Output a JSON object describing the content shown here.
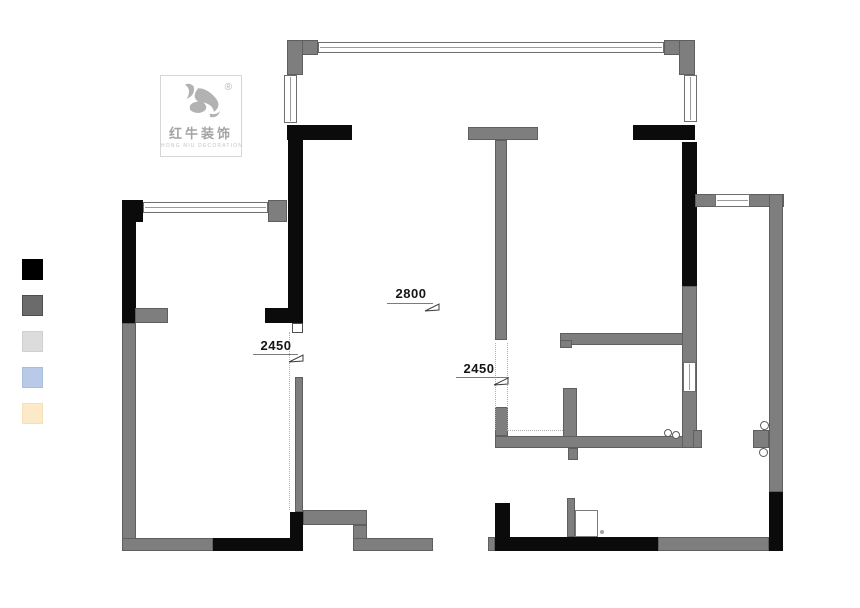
{
  "canvas": {
    "width": 860,
    "height": 608,
    "background": "#ffffff"
  },
  "logo": {
    "brand_cn": "红牛装饰",
    "brand_en": "HONG NIU DECORATION",
    "registered_mark": "®",
    "icon": "bull-logo-icon",
    "icon_color": "#b2b2b2"
  },
  "legend": {
    "swatches": [
      {
        "name": "black",
        "color": "#000000",
        "border": "#000000"
      },
      {
        "name": "dark-gray",
        "color": "#6b6b6b",
        "border": "#4e4e4e"
      },
      {
        "name": "light-gray",
        "color": "#dcdcdc",
        "border": "#d0d0d0"
      },
      {
        "name": "light-blue",
        "color": "#b8cae8",
        "border": "#a9bddf"
      },
      {
        "name": "cream",
        "color": "#fce9c8",
        "border": "#f6e0b8"
      }
    ]
  },
  "dimensions": [
    {
      "label": "2800",
      "text": {
        "x": 388,
        "y": 286,
        "w": 46
      },
      "line": {
        "x": 387,
        "y": 303,
        "w": 46
      },
      "flag": {
        "x": 424,
        "y": 303
      }
    },
    {
      "label": "2450",
      "text": {
        "x": 254,
        "y": 338,
        "w": 44
      },
      "line": {
        "x": 253,
        "y": 354,
        "w": 45
      },
      "flag": {
        "x": 288,
        "y": 354
      }
    },
    {
      "label": "2450",
      "text": {
        "x": 457,
        "y": 361,
        "w": 44
      },
      "line": {
        "x": 456,
        "y": 377,
        "w": 53
      },
      "flag": {
        "x": 493,
        "y": 377
      }
    }
  ],
  "floorplan": {
    "wall_color_black": "#0b0b0b",
    "wall_color_gray": "#7e7e7e",
    "black_walls": [
      {
        "x": 287,
        "y": 125,
        "w": 65,
        "h": 15
      },
      {
        "x": 633,
        "y": 125,
        "w": 62,
        "h": 15
      },
      {
        "x": 288,
        "y": 140,
        "w": 15,
        "h": 183
      },
      {
        "x": 265,
        "y": 308,
        "w": 38,
        "h": 15
      },
      {
        "x": 122,
        "y": 200,
        "w": 21,
        "h": 22
      },
      {
        "x": 122,
        "y": 222,
        "w": 14,
        "h": 101
      },
      {
        "x": 682,
        "y": 142,
        "w": 15,
        "h": 144
      },
      {
        "x": 213,
        "y": 538,
        "w": 90,
        "h": 13
      },
      {
        "x": 290,
        "y": 512,
        "w": 13,
        "h": 26
      },
      {
        "x": 495,
        "y": 503,
        "w": 15,
        "h": 34
      },
      {
        "x": 495,
        "y": 537,
        "w": 163,
        "h": 14
      },
      {
        "x": 769,
        "y": 492,
        "w": 14,
        "h": 59
      }
    ],
    "gray_walls": [
      {
        "x": 287,
        "y": 40,
        "w": 31,
        "h": 15
      },
      {
        "x": 287,
        "y": 40,
        "w": 16,
        "h": 35
      },
      {
        "x": 664,
        "y": 40,
        "w": 31,
        "h": 15
      },
      {
        "x": 679,
        "y": 40,
        "w": 16,
        "h": 35
      },
      {
        "x": 468,
        "y": 127,
        "w": 70,
        "h": 13
      },
      {
        "x": 495,
        "y": 140,
        "w": 12,
        "h": 200
      },
      {
        "x": 268,
        "y": 200,
        "w": 19,
        "h": 22
      },
      {
        "x": 135,
        "y": 308,
        "w": 33,
        "h": 15
      },
      {
        "x": 122,
        "y": 323,
        "w": 14,
        "h": 228
      },
      {
        "x": 122,
        "y": 538,
        "w": 91,
        "h": 13
      },
      {
        "x": 303,
        "y": 510,
        "w": 64,
        "h": 15
      },
      {
        "x": 353,
        "y": 525,
        "w": 14,
        "h": 26
      },
      {
        "x": 353,
        "y": 538,
        "w": 80,
        "h": 13
      },
      {
        "x": 295,
        "y": 377,
        "w": 8,
        "h": 135
      },
      {
        "x": 560,
        "y": 333,
        "w": 123,
        "h": 12
      },
      {
        "x": 560,
        "y": 340,
        "w": 12,
        "h": 8
      },
      {
        "x": 563,
        "y": 388,
        "w": 14,
        "h": 60
      },
      {
        "x": 568,
        "y": 448,
        "w": 10,
        "h": 12
      },
      {
        "x": 495,
        "y": 436,
        "w": 202,
        "h": 12
      },
      {
        "x": 495,
        "y": 407,
        "w": 13,
        "h": 29
      },
      {
        "x": 682,
        "y": 286,
        "w": 15,
        "h": 162
      },
      {
        "x": 693,
        "y": 430,
        "w": 9,
        "h": 18
      },
      {
        "x": 695,
        "y": 194,
        "w": 89,
        "h": 13
      },
      {
        "x": 769,
        "y": 194,
        "w": 14,
        "h": 298
      },
      {
        "x": 753,
        "y": 430,
        "w": 16,
        "h": 18
      },
      {
        "x": 658,
        "y": 537,
        "w": 111,
        "h": 14
      },
      {
        "x": 488,
        "y": 537,
        "w": 7,
        "h": 14
      },
      {
        "x": 567,
        "y": 498,
        "w": 8,
        "h": 39
      }
    ],
    "windows": [
      {
        "x": 318,
        "y": 42,
        "w": 346,
        "h": 11,
        "o": "h"
      },
      {
        "x": 284,
        "y": 75,
        "w": 13,
        "h": 48,
        "o": "v"
      },
      {
        "x": 684,
        "y": 75,
        "w": 13,
        "h": 47,
        "o": "v"
      },
      {
        "x": 143,
        "y": 202,
        "w": 125,
        "h": 11,
        "o": "h"
      },
      {
        "x": 715,
        "y": 194,
        "w": 35,
        "h": 13,
        "o": "h"
      },
      {
        "x": 683,
        "y": 362,
        "w": 13,
        "h": 30,
        "o": "v"
      }
    ],
    "door_frames": [
      {
        "x": 292,
        "y": 323,
        "w": 11,
        "h": 10
      }
    ],
    "door_leaves": [
      {
        "x": 575,
        "y": 510,
        "w": 23,
        "h": 27
      }
    ],
    "circles": [
      {
        "x": 664,
        "y": 429,
        "d": 8
      },
      {
        "x": 672,
        "y": 431,
        "d": 8
      },
      {
        "x": 760,
        "y": 421,
        "d": 9
      },
      {
        "x": 759,
        "y": 448,
        "d": 9
      },
      {
        "x": 600,
        "y": 530,
        "d": 4,
        "dot": true
      }
    ],
    "dashed_lines": [
      {
        "x": 289,
        "y": 332,
        "len": 178,
        "o": "v"
      },
      {
        "x": 495,
        "y": 343,
        "len": 87,
        "o": "v"
      },
      {
        "x": 507,
        "y": 343,
        "len": 87,
        "o": "v"
      },
      {
        "x": 507,
        "y": 430,
        "len": 56,
        "o": "h"
      }
    ]
  }
}
